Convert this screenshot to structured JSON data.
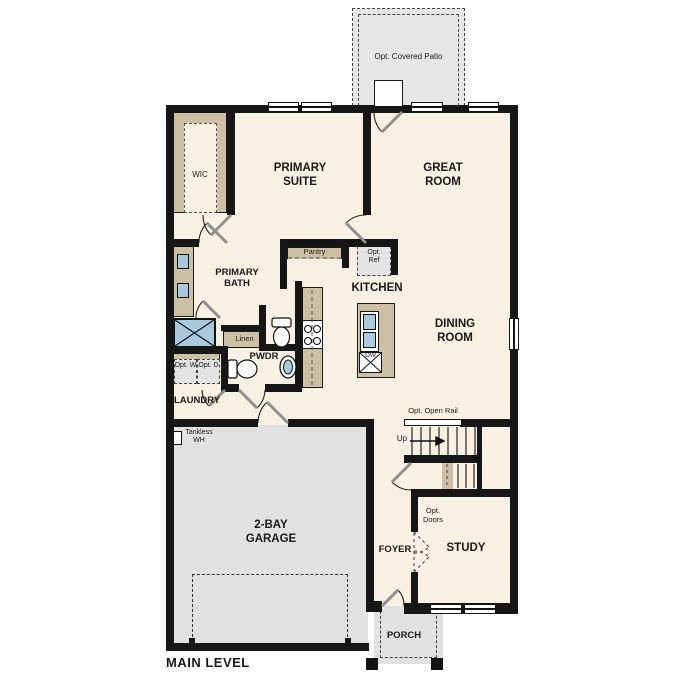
{
  "plan": {
    "title": "MAIN LEVEL",
    "rooms": {
      "patio": "Opt. Covered Patio",
      "primary_suite": "PRIMARY SUITE",
      "great_room": "GREAT ROOM",
      "wic": "WIC",
      "primary_bath": "PRIMARY BATH",
      "pantry": "Pantry",
      "opt_ref": "Opt. Ref",
      "kitchen": "KITCHEN",
      "dining_room": "DINING ROOM",
      "linen": "Linen",
      "pwdr": "PWDR",
      "opt_w": "Opt. W",
      "opt_d": "Opt. D",
      "laundry": "LAUNDRY",
      "tankless_wh": "Tankless WH",
      "island_dw": "DW",
      "stairs_rail": "Opt. Open Rail",
      "stairs_up": "Up",
      "garage": "2-BAY GARAGE",
      "opt_doors": "Opt. Doors",
      "foyer": "FOYER",
      "study": "STUDY",
      "porch": "PORCH"
    },
    "colors": {
      "floor": "#f8f0e3",
      "garage_floor": "#e1e1e1",
      "patio_floor": "#e6e6e6",
      "wall": "#161616",
      "cabinetry": "#cdbfa3",
      "fixture_blue": "#a9cade"
    }
  }
}
